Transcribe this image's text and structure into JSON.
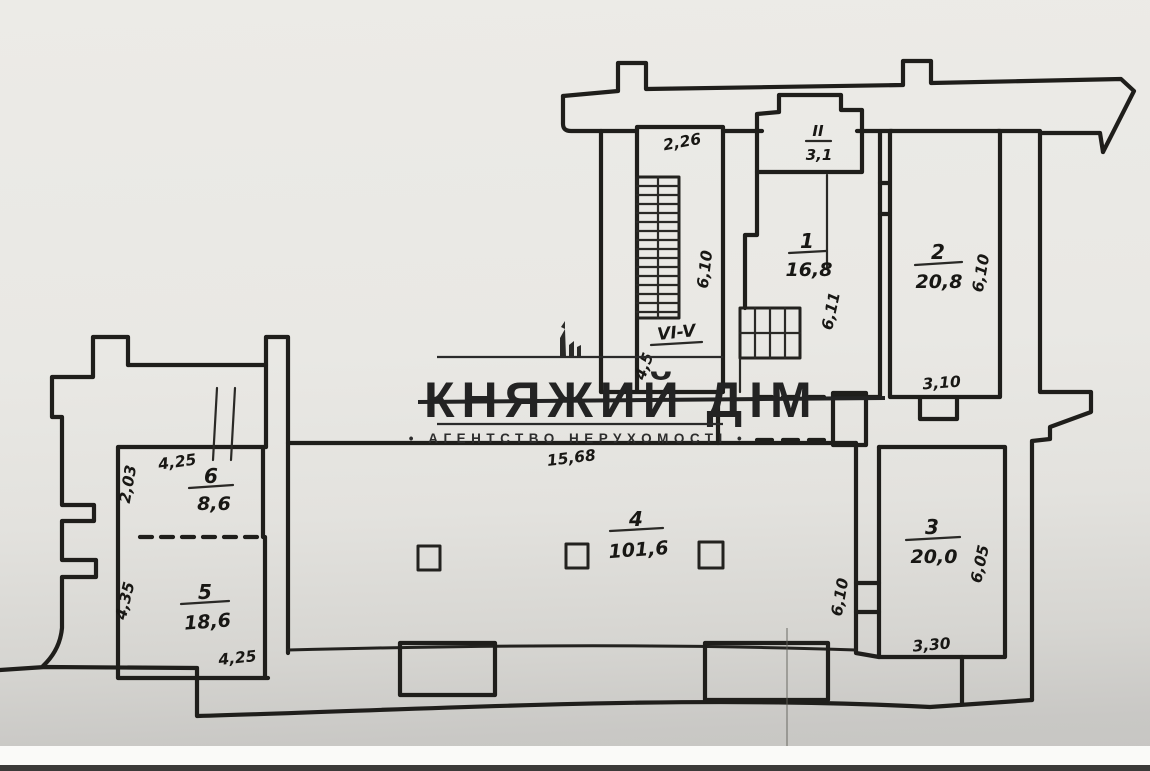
{
  "watermark": {
    "title": "КНЯЖИЙ ДІМ",
    "subtitle": "• АГЕНТСТВО НЕРУХОМОСТІ •",
    "logo_icon": "building-towers-icon"
  },
  "rooms": {
    "stair_hall": {
      "dim_width": "2,26",
      "dim_depth": "6,10",
      "section_label": "VI-V",
      "section_dim": "4,5"
    },
    "vestibule": {
      "number": "II",
      "area": "3,1"
    },
    "room1": {
      "number": "1",
      "area": "16,8",
      "dim_depth": "6,11"
    },
    "room2": {
      "number": "2",
      "area": "20,8",
      "dim_depth": "6,10",
      "dim_width": "3,10"
    },
    "room3": {
      "number": "3",
      "area": "20,0",
      "dim_depth": "6,05",
      "dim_width": "3,30"
    },
    "room4": {
      "number": "4",
      "area": "101,6",
      "dim_width": "15,68",
      "dim_depth": "6,10"
    },
    "room5": {
      "number": "5",
      "area": "18,6",
      "dim_width": "4,25",
      "dim_depth": "4,35"
    },
    "room6": {
      "number": "6",
      "area": "8,6",
      "dim_width": "4,25",
      "dim_depth": "2,03"
    }
  }
}
